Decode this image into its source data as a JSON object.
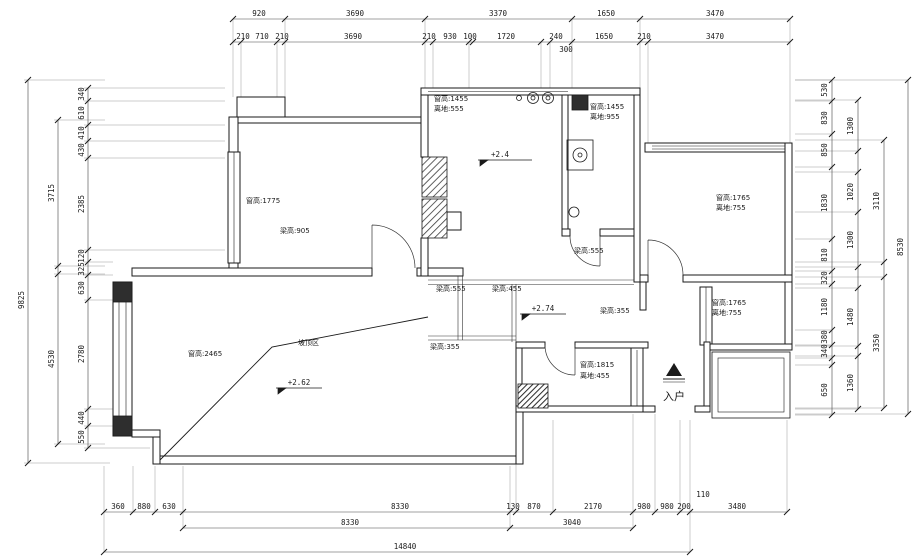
{
  "colors": {
    "wall_line": "#1a1a1a",
    "dim_line": "#444444",
    "extension_line": "#999999",
    "hatch": "#3a3a3a",
    "background": "#ffffff"
  },
  "dims": {
    "top1": [
      "920",
      "3690",
      "3370",
      "1650",
      "3470"
    ],
    "top2": [
      "210",
      "710",
      "210",
      "3690",
      "210",
      "930",
      "100",
      "1720",
      "240",
      "1650",
      "210",
      "3470"
    ],
    "top2_offset": "300",
    "left_outer": "9825",
    "left_mid": [
      "3715",
      "4530"
    ],
    "left_inner": [
      "340",
      "610",
      "410",
      "430",
      "2385",
      "120",
      "325",
      "630",
      "2780",
      "440",
      "550"
    ],
    "right_inner": [
      "530",
      "830",
      "850",
      "1830",
      "810",
      "320",
      "1180",
      "380",
      "340",
      "650"
    ],
    "right_mid": [
      "1300",
      "1020",
      "1300",
      "1480",
      "1360"
    ],
    "right_mid2": [
      "3110",
      "3350"
    ],
    "right_outer": "8530",
    "bottom1": [
      "360",
      "880",
      "630",
      "8330",
      "130",
      "870",
      "2170",
      "980",
      "980",
      "200",
      "3480"
    ],
    "bottom1_offset": "110",
    "bottom2": [
      "8330",
      "3040"
    ],
    "bottom3": "14840"
  },
  "labels": {
    "win_n1": {
      "l1": "窗高:1455",
      "l2": "离地:555"
    },
    "win_n2": {
      "l1": "窗高:1455",
      "l2": "离地:955"
    },
    "win_w": "窗高:1775",
    "beam_w": "梁高:905",
    "win_e1": {
      "l1": "窗高:1765",
      "l2": "离地:755"
    },
    "win_e2": {
      "l1": "窗高:1765",
      "l2": "离地:755"
    },
    "win_s": {
      "l1": "窗高:1815",
      "l2": "离地:455"
    },
    "win_bay": "窗高:2465",
    "slope": "坡顶区",
    "entry": "入户",
    "beam1": "梁高:555",
    "beam2": "梁高:455",
    "beam3": "梁高:555",
    "beam4": "梁高:355",
    "beam5": "梁高:355",
    "lvl1": "+2.4",
    "lvl2": "+2.74",
    "lvl3": "+2.62"
  }
}
